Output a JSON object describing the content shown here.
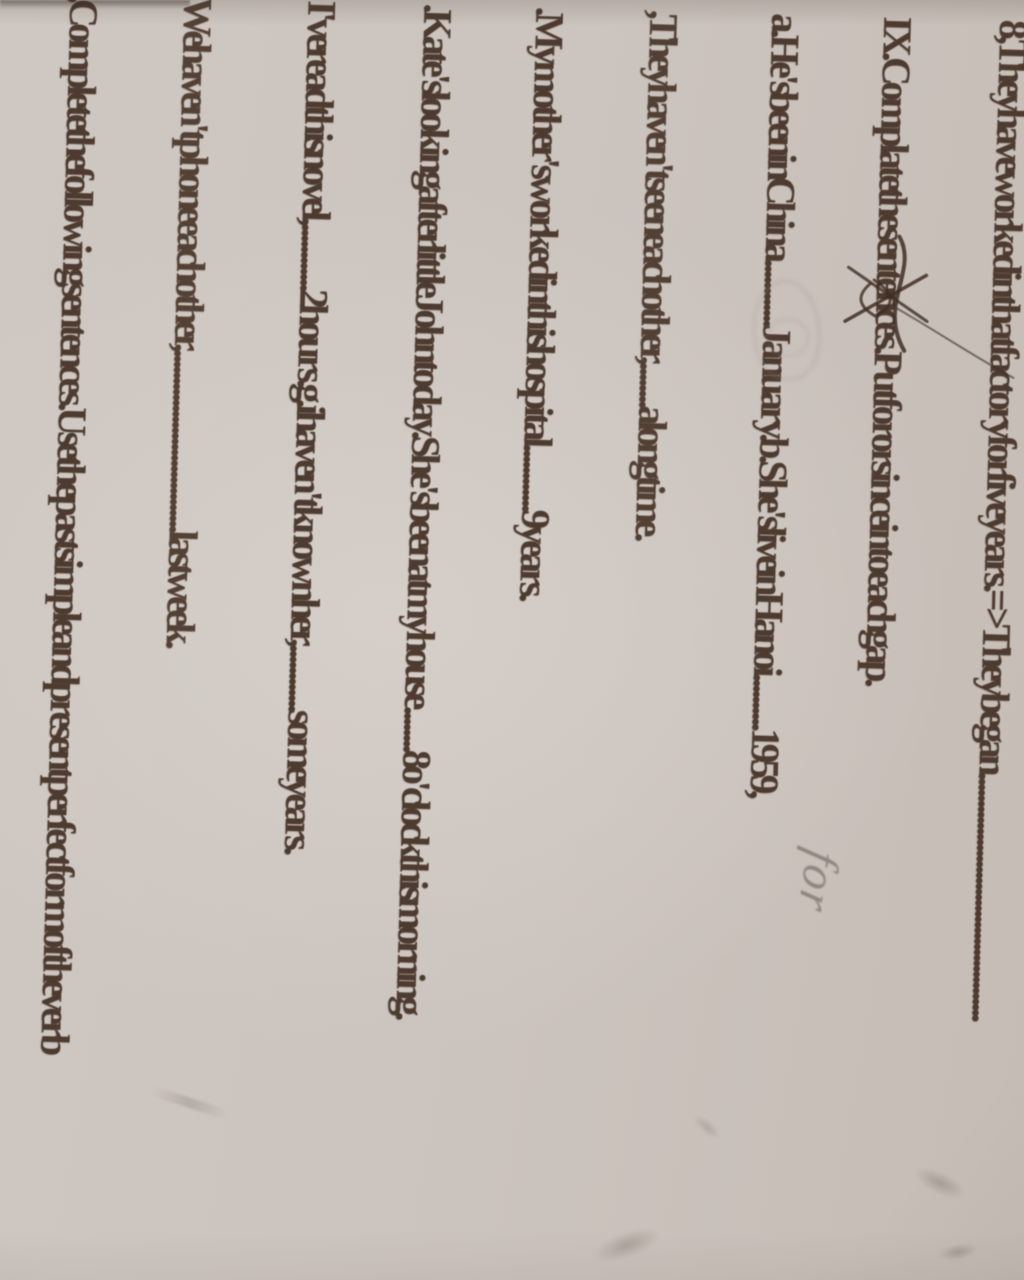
{
  "page": {
    "type": "photographed worksheet page",
    "orientation": "text rotated 90 degrees clockwise"
  },
  "document": {
    "lines": [
      {
        "id": "example-8",
        "text": "8, They have worked in that factory for five years.=> They began ............................................."
      },
      {
        "id": "exercise-ix-heading",
        "text": "IX. Complate the sentences. Put for or since into each gap."
      },
      {
        "id": "item-a-b",
        "text": "a.He's been in China............January.   b.She's live in Ha noi..........1959,"
      },
      {
        "id": "item-c",
        "text": ", They haven't seen each other,........a long time."
      },
      {
        "id": "item-d",
        "text": ".My mother's worked in this hospital............9 years."
      },
      {
        "id": "item-e",
        "text": ".Kate's looking after little John today. She's been at my house........8 o'clock this morning."
      },
      {
        "id": "item-f-g",
        "text": "I've read this novel,............2 hours.  g.i haven't known her,............some years."
      },
      {
        "id": "item-h",
        "text": "We haven't phone each other,.................................last week."
      },
      {
        "id": "exercise-x-heading",
        "text": ", Complete the following sentences. Use the past simple and present perfect form of the verb"
      }
    ]
  },
  "annotations": {
    "pencil_word": "for"
  },
  "colors": {
    "paper": "#cdc5bf",
    "print_ink": "#4d3b30",
    "pencil": "#80766e",
    "scribble_ink": "#3f2e23"
  }
}
